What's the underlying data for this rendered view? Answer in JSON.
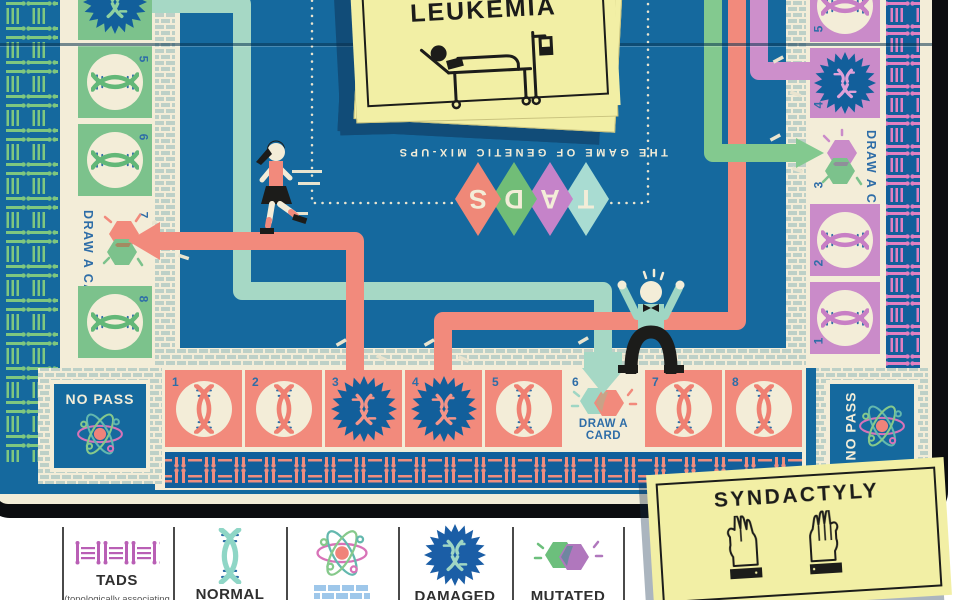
{
  "board": {
    "subtitle": "THE GAME OF GENETIC MIX-UPS",
    "title_letters": [
      "T",
      "A",
      "D",
      "S"
    ],
    "draw_card_label": "DRAW A CARD",
    "no_pass_label": "NO PASS",
    "numbers": {
      "l5": "5",
      "l6": "6",
      "l7": "7",
      "l8": "8",
      "b1": "1",
      "b2": "2",
      "b3": "3",
      "b4": "4",
      "b5": "5",
      "b6": "6",
      "b7": "7",
      "b8": "8",
      "r1": "1",
      "r2": "2",
      "r3": "3",
      "r4": "4",
      "r5": "5"
    }
  },
  "cards": {
    "draw_pile": {
      "title": "LEUKEMIA"
    },
    "played_card": {
      "title": "SYNDACTYLY"
    }
  },
  "legend": {
    "items": [
      {
        "label": "TADS",
        "sublabel": "(topologically associating domains)"
      },
      {
        "label": "NORMAL"
      },
      {
        "label": ""
      },
      {
        "label": "DAMAGED"
      },
      {
        "label": "MUTATED"
      }
    ]
  },
  "colors": {
    "board_blue": "#15699e",
    "star_blue": "#125f9b",
    "cream": "#f3edd8",
    "green": "#7cc28c",
    "salmon": "#f28a7c",
    "pink": "#ca8bc9",
    "mint": "#a6d8c5",
    "magenta": "#b95fb5",
    "number_blue": "#2e6da7",
    "card_yellow": "#f2efa5"
  }
}
